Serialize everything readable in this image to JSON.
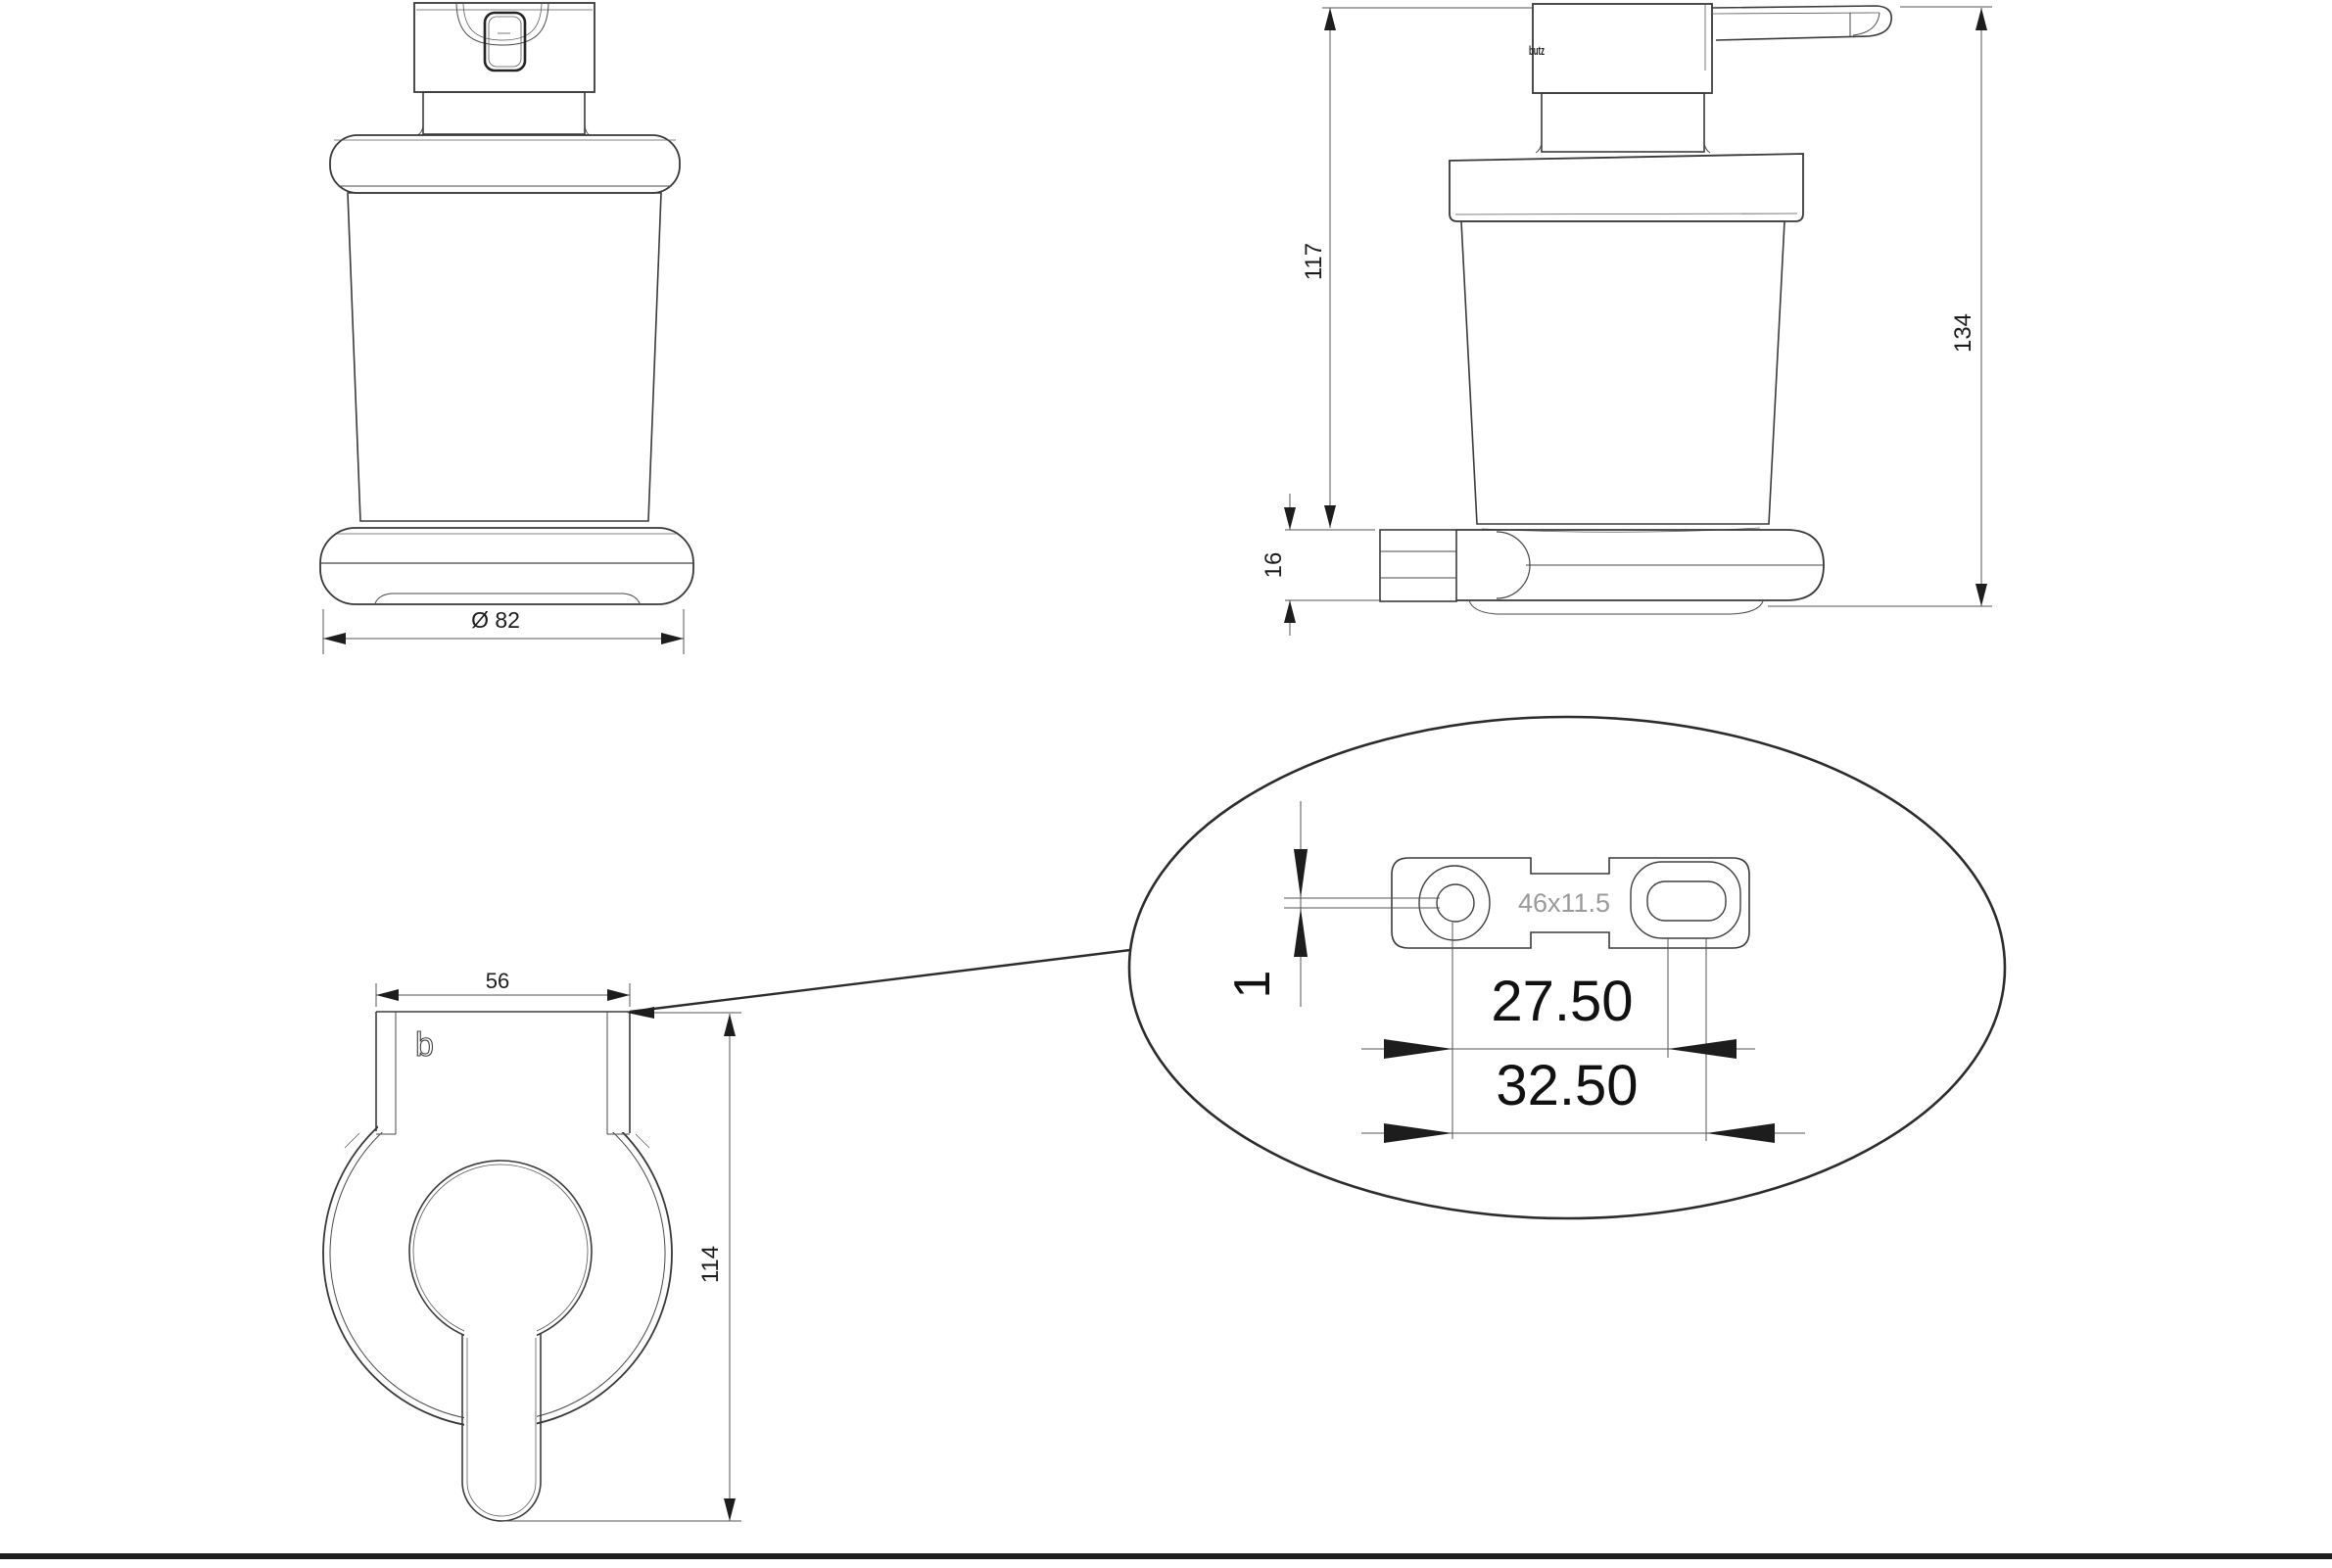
{
  "page": {
    "background": "#ffffff",
    "frame_color": "#1f1f1f",
    "line_color": "#3b3b3b",
    "dimension_color": "#555555",
    "gray_text_color": "#9a9a9a"
  },
  "views": {
    "front": {
      "title": "front-view-soap-dispenser",
      "diameter_label": "Ø 82"
    },
    "side": {
      "title": "side-view-soap-dispenser",
      "glass_height_label": "117",
      "bracket_height_label": "16",
      "total_height_label": "134",
      "logo_label": "butz"
    },
    "back": {
      "title": "back-view-wall-bracket",
      "plate_width_label": "56",
      "height_label": "114",
      "logo_label": "b"
    },
    "detail": {
      "title": "mounting-plate-detail",
      "offset_label": "1",
      "hole_pitch_label": "27.50",
      "outer_pitch_label": "32.50",
      "slot_size_label": "46x11.5"
    }
  }
}
